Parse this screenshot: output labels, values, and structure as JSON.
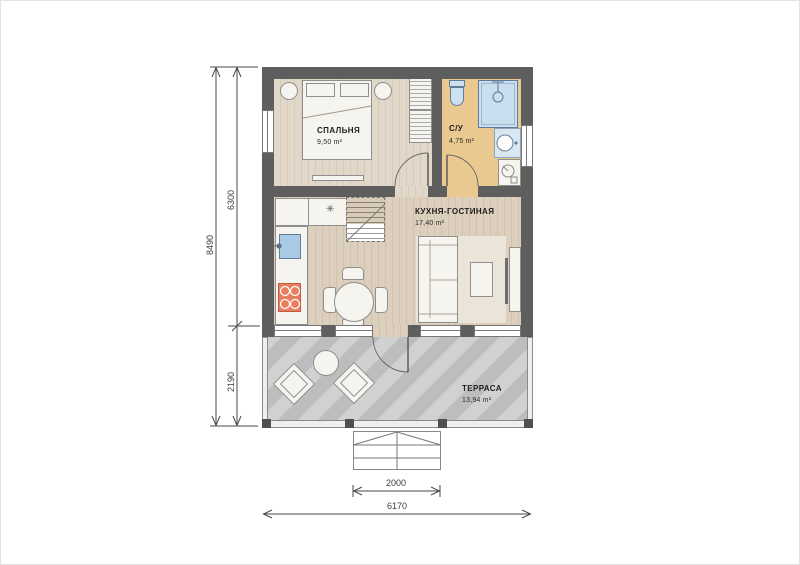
{
  "rooms": [
    {
      "name": "СПАЛЬНЯ",
      "area": "9,50 m²"
    },
    {
      "name": "С/У",
      "area": "4,75 m²"
    },
    {
      "name": "КУХНЯ-ГОСТИНАЯ",
      "area": "17,40 m²"
    },
    {
      "name": "ТЕРРАСА",
      "area": "13,94 m²"
    }
  ],
  "dimensions": {
    "overall_height": "8490",
    "house_depth": "6300",
    "terrace_depth": "2190",
    "porch_width": "2000",
    "overall_width": "6170"
  },
  "symbols": {
    "fridge": "✳"
  },
  "colors": {
    "wall": "#5e5e5e",
    "wood_floor": "#dccfbd",
    "bathroom_floor": "#eac991",
    "terrace_floor": "#c7c7c7",
    "fixture_blue": "#cde0f0",
    "stove": "#e87f60"
  }
}
